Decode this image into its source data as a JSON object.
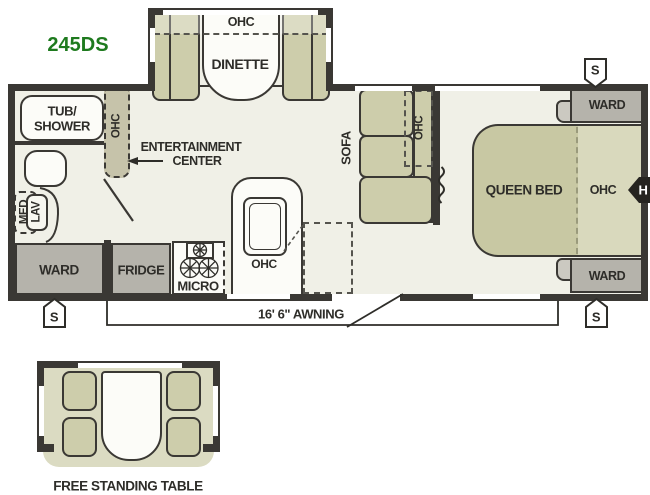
{
  "model": "245DS",
  "colors": {
    "model_green": "#1e7a1e",
    "wall": "#3a3834",
    "floor": "#f0f0e7",
    "olive_furniture": "#cdcdab",
    "gray_furniture": "#b5b3ab",
    "bed": "#c8c8a3",
    "bed_ohc_area": "#d9d9bd"
  },
  "dinette": {
    "ohc": "OHC",
    "label": "DINETTE"
  },
  "bathroom": {
    "tub_line1": "TUB/",
    "tub_line2": "SHOWER",
    "med": "MED",
    "lav": "LAV"
  },
  "entertainment": {
    "ohc": "OHC",
    "label_line1": "ENTERTAINMENT",
    "label_line2": "CENTER"
  },
  "living": {
    "sofa": "SOFA",
    "ohc": "OHC"
  },
  "kitchen": {
    "ward": "WARD",
    "fridge": "FRIDGE",
    "micro": "MICRO",
    "ohc": "OHC"
  },
  "bedroom": {
    "bed": "QUEEN BED",
    "ohc": "OHC",
    "ward_top": "WARD",
    "ward_bottom": "WARD"
  },
  "markers": {
    "speaker_top_right": "S",
    "speaker_bottom_left": "S",
    "speaker_bottom_right": "S",
    "hitch": "H"
  },
  "awning": {
    "label": "16' 6\" AWNING"
  },
  "option": {
    "label": "FREE STANDING TABLE"
  }
}
